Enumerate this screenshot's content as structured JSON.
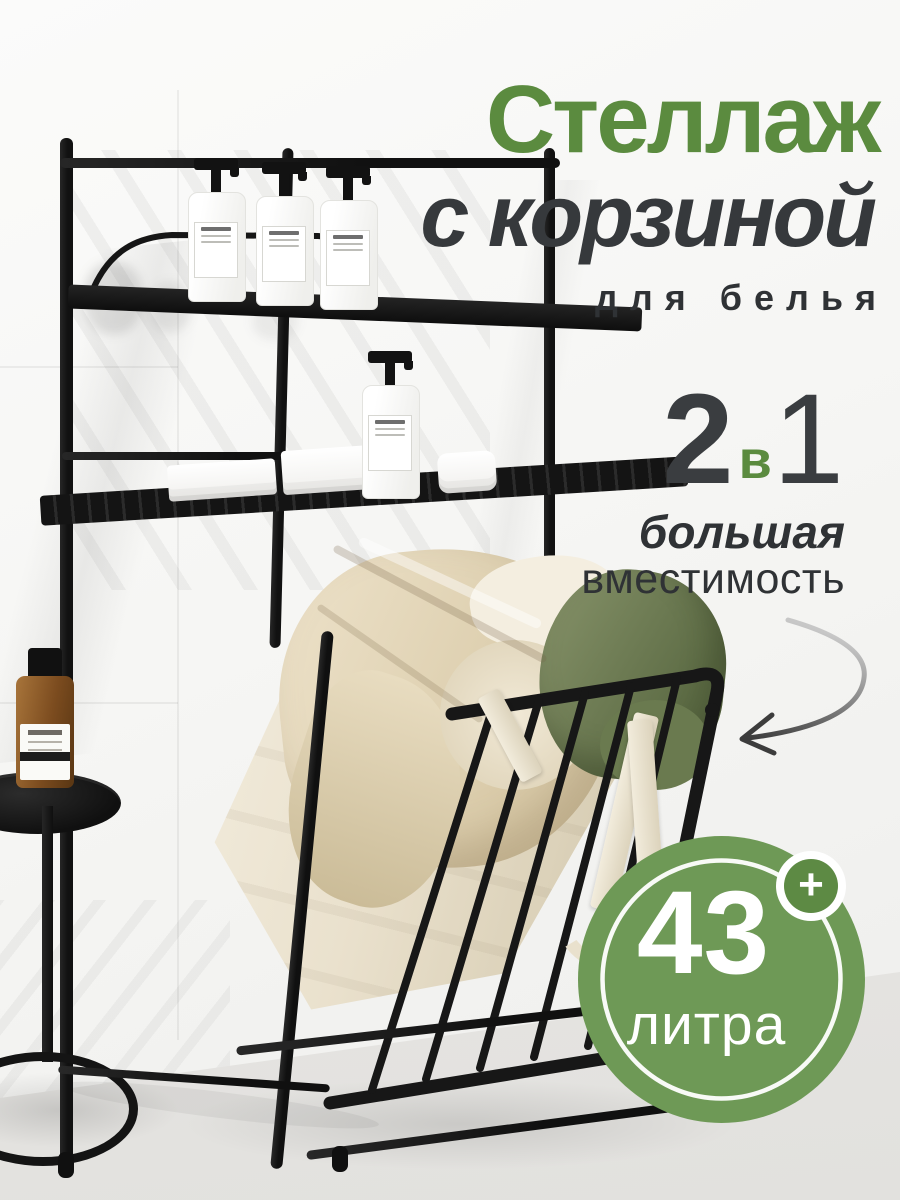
{
  "overlay": {
    "title": {
      "line1": "Стеллаж",
      "line2": "с корзиной",
      "subtitle": "для белья"
    },
    "ratio": {
      "left": "2",
      "middle": "в",
      "right": "1"
    },
    "capacity": {
      "line1": "большая",
      "line2": "вместимость"
    },
    "badge": {
      "value": "43",
      "unit": "литра",
      "plus": "+"
    }
  },
  "colors": {
    "accent_green": "#5b8b3f",
    "text_dark": "#34373a",
    "badge_green": "#6e9956",
    "badge_plus_green": "#5d8a44",
    "badge_text": "#ffffff",
    "metal_black": "#181818",
    "basket_fabric": "#eae1cc",
    "clothes_green": "#75855c",
    "background": "#f4f4f2"
  },
  "scene_items": [
    "laundry-rack",
    "pump-bottles",
    "folded-towels",
    "tilted-laundry-basket",
    "clothes-pile",
    "fabric-strap",
    "round-side-table",
    "amber-bottle",
    "curved-arrow"
  ]
}
